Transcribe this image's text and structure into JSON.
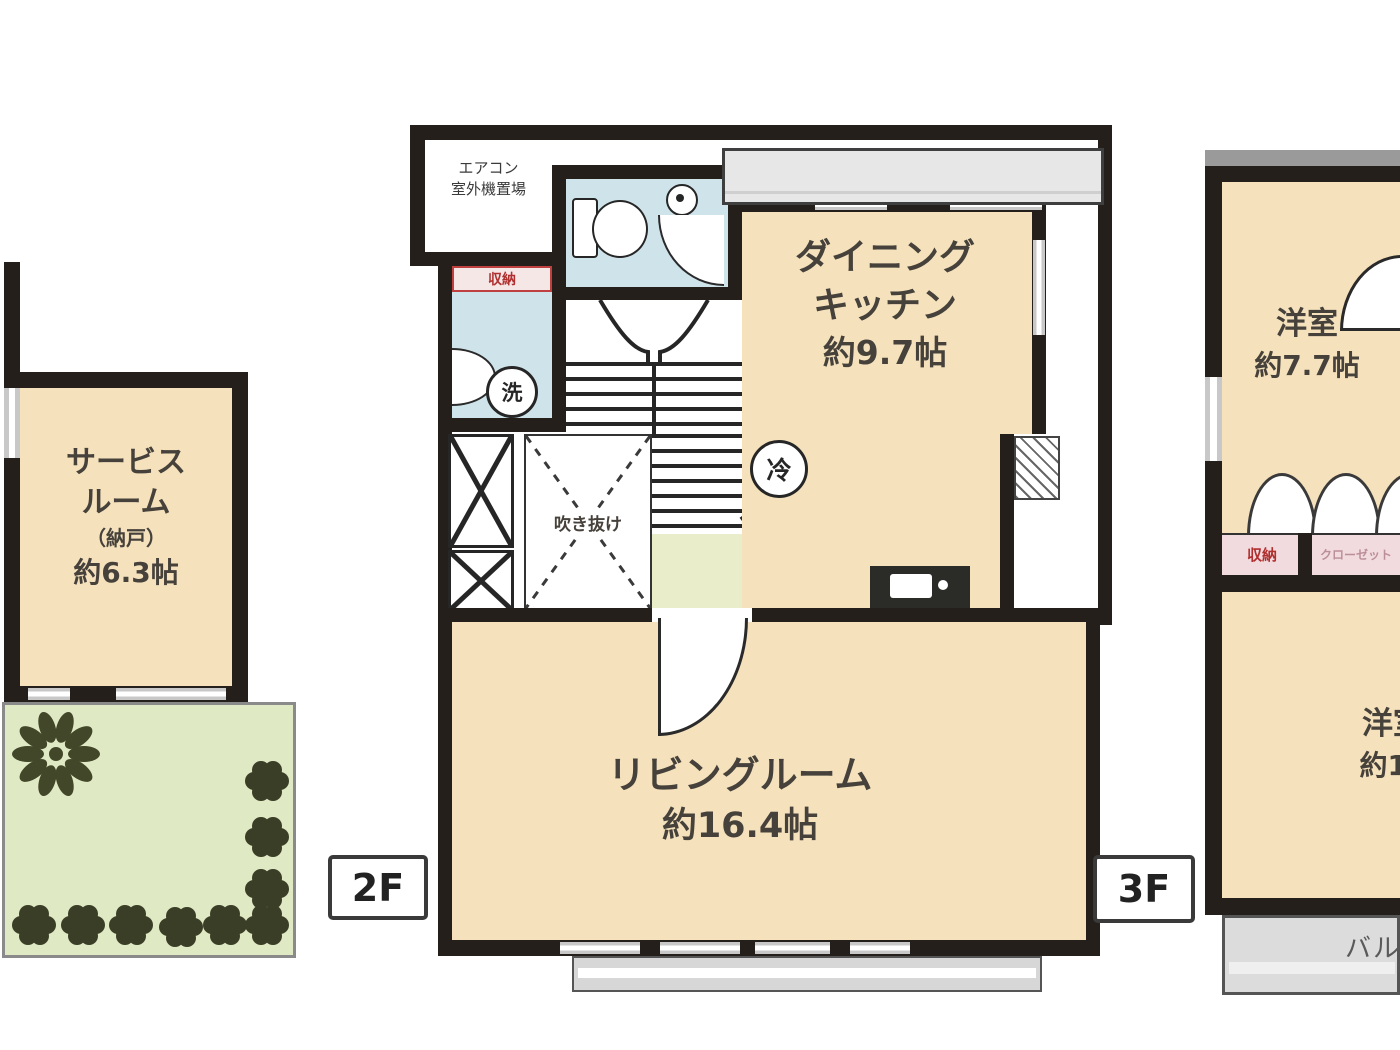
{
  "floor_labels": {
    "middle": "2F",
    "right": "3F"
  },
  "left_plan": {
    "service_room": {
      "line1": "サービス",
      "line2": "ルーム",
      "line3": "（納戸）",
      "line4": "約6.3帖"
    }
  },
  "middle_plan": {
    "aircon": {
      "line1": "エアコン",
      "line2": "室外機置場"
    },
    "storage_label": "収納",
    "laundry_circle": "洗",
    "fridge_circle": "冷",
    "void_label": "吹き抜け",
    "dining_kitchen": {
      "line1": "ダイニング",
      "line2": "キッチン",
      "size": "約9.7帖"
    },
    "living_room": {
      "name": "リビングルーム",
      "size": "約16.4帖"
    }
  },
  "right_plan": {
    "bedroom1": {
      "name": "洋室",
      "size": "約7.7帖"
    },
    "closet": {
      "left": "収納",
      "right": "クローゼット"
    },
    "bedroom2": {
      "name": "洋室",
      "size": "約10"
    },
    "balcony": "バルコニー"
  },
  "colors": {
    "wall": "#241f1b",
    "room_cream": "#f5e2bd",
    "wet_blue": "#cfe4ea",
    "terrace_green": "#dfe9c4",
    "hall_green": "#e9edca",
    "balcony_gray": "#dcdcdc",
    "closet_pink": "#f2dbdf",
    "accent_red": "#b03030"
  }
}
